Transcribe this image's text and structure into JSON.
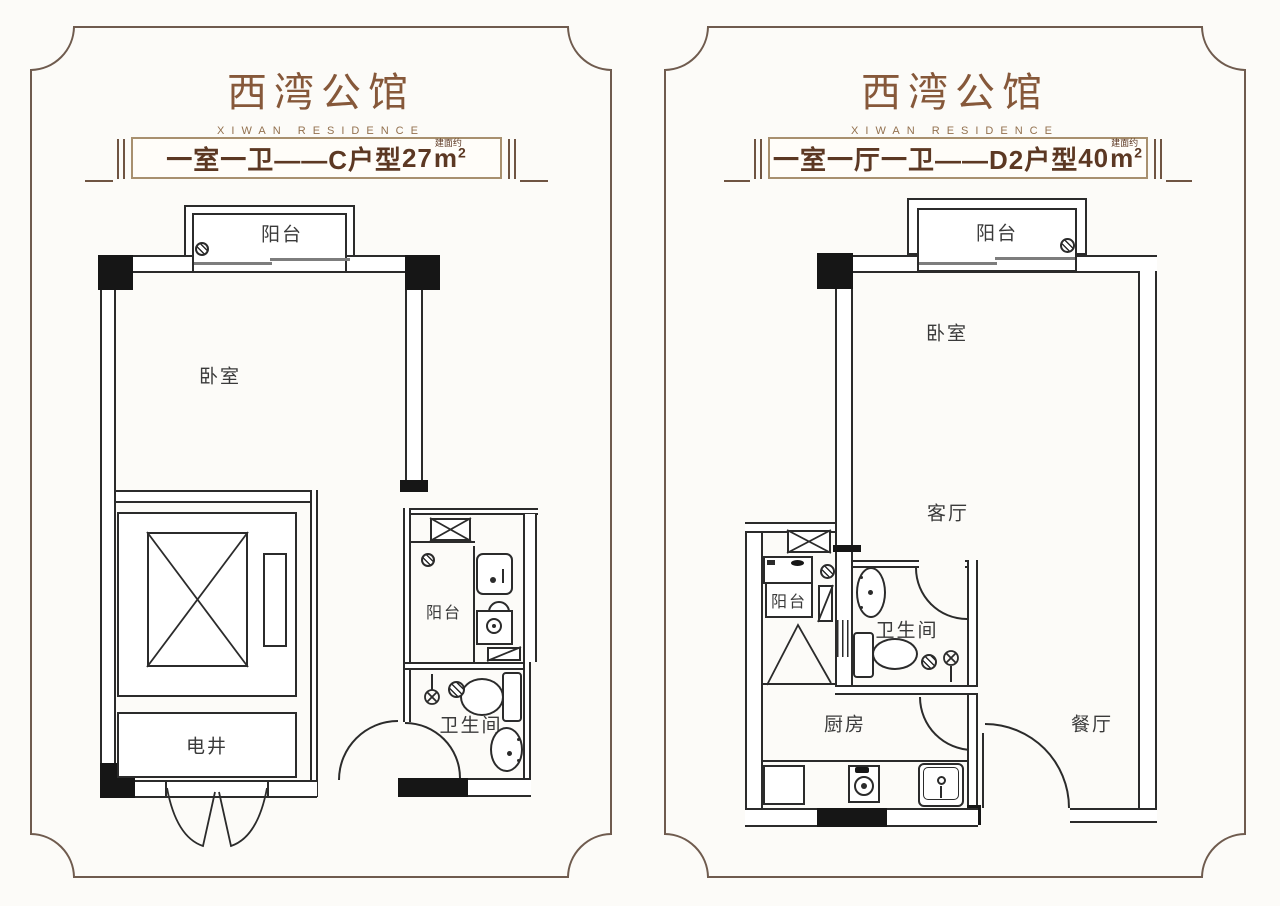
{
  "colors": {
    "frame_border": "#6f5b4e",
    "brand_text": "#86583a",
    "banner_text": "#5c3823",
    "plan_line": "#2b2b2b",
    "column_fill": "#161616"
  },
  "panels": [
    {
      "brand_title": "西湾公馆",
      "brand_subtitle": "XIWAN RESIDENCE",
      "banner": {
        "text": "一室一卫——C户型",
        "area": "27",
        "area_note": "建面约",
        "unit": "m",
        "sup": "2"
      },
      "rooms": {
        "balcony": "阳台",
        "bedroom": "卧室",
        "shaft": "电井",
        "utility_balcony": "阳台",
        "bathroom": "卫生间"
      }
    },
    {
      "brand_title": "西湾公馆",
      "brand_subtitle": "XIWAN RESIDENCE",
      "banner": {
        "text": "一室一厅一卫——D2户型",
        "area": "40",
        "area_note": "建面约",
        "unit": "m",
        "sup": "2"
      },
      "rooms": {
        "balcony": "阳台",
        "bedroom": "卧室",
        "living": "客厅",
        "utility_balcony": "阳台",
        "bathroom": "卫生间",
        "kitchen": "厨房",
        "dining": "餐厅"
      }
    }
  ]
}
